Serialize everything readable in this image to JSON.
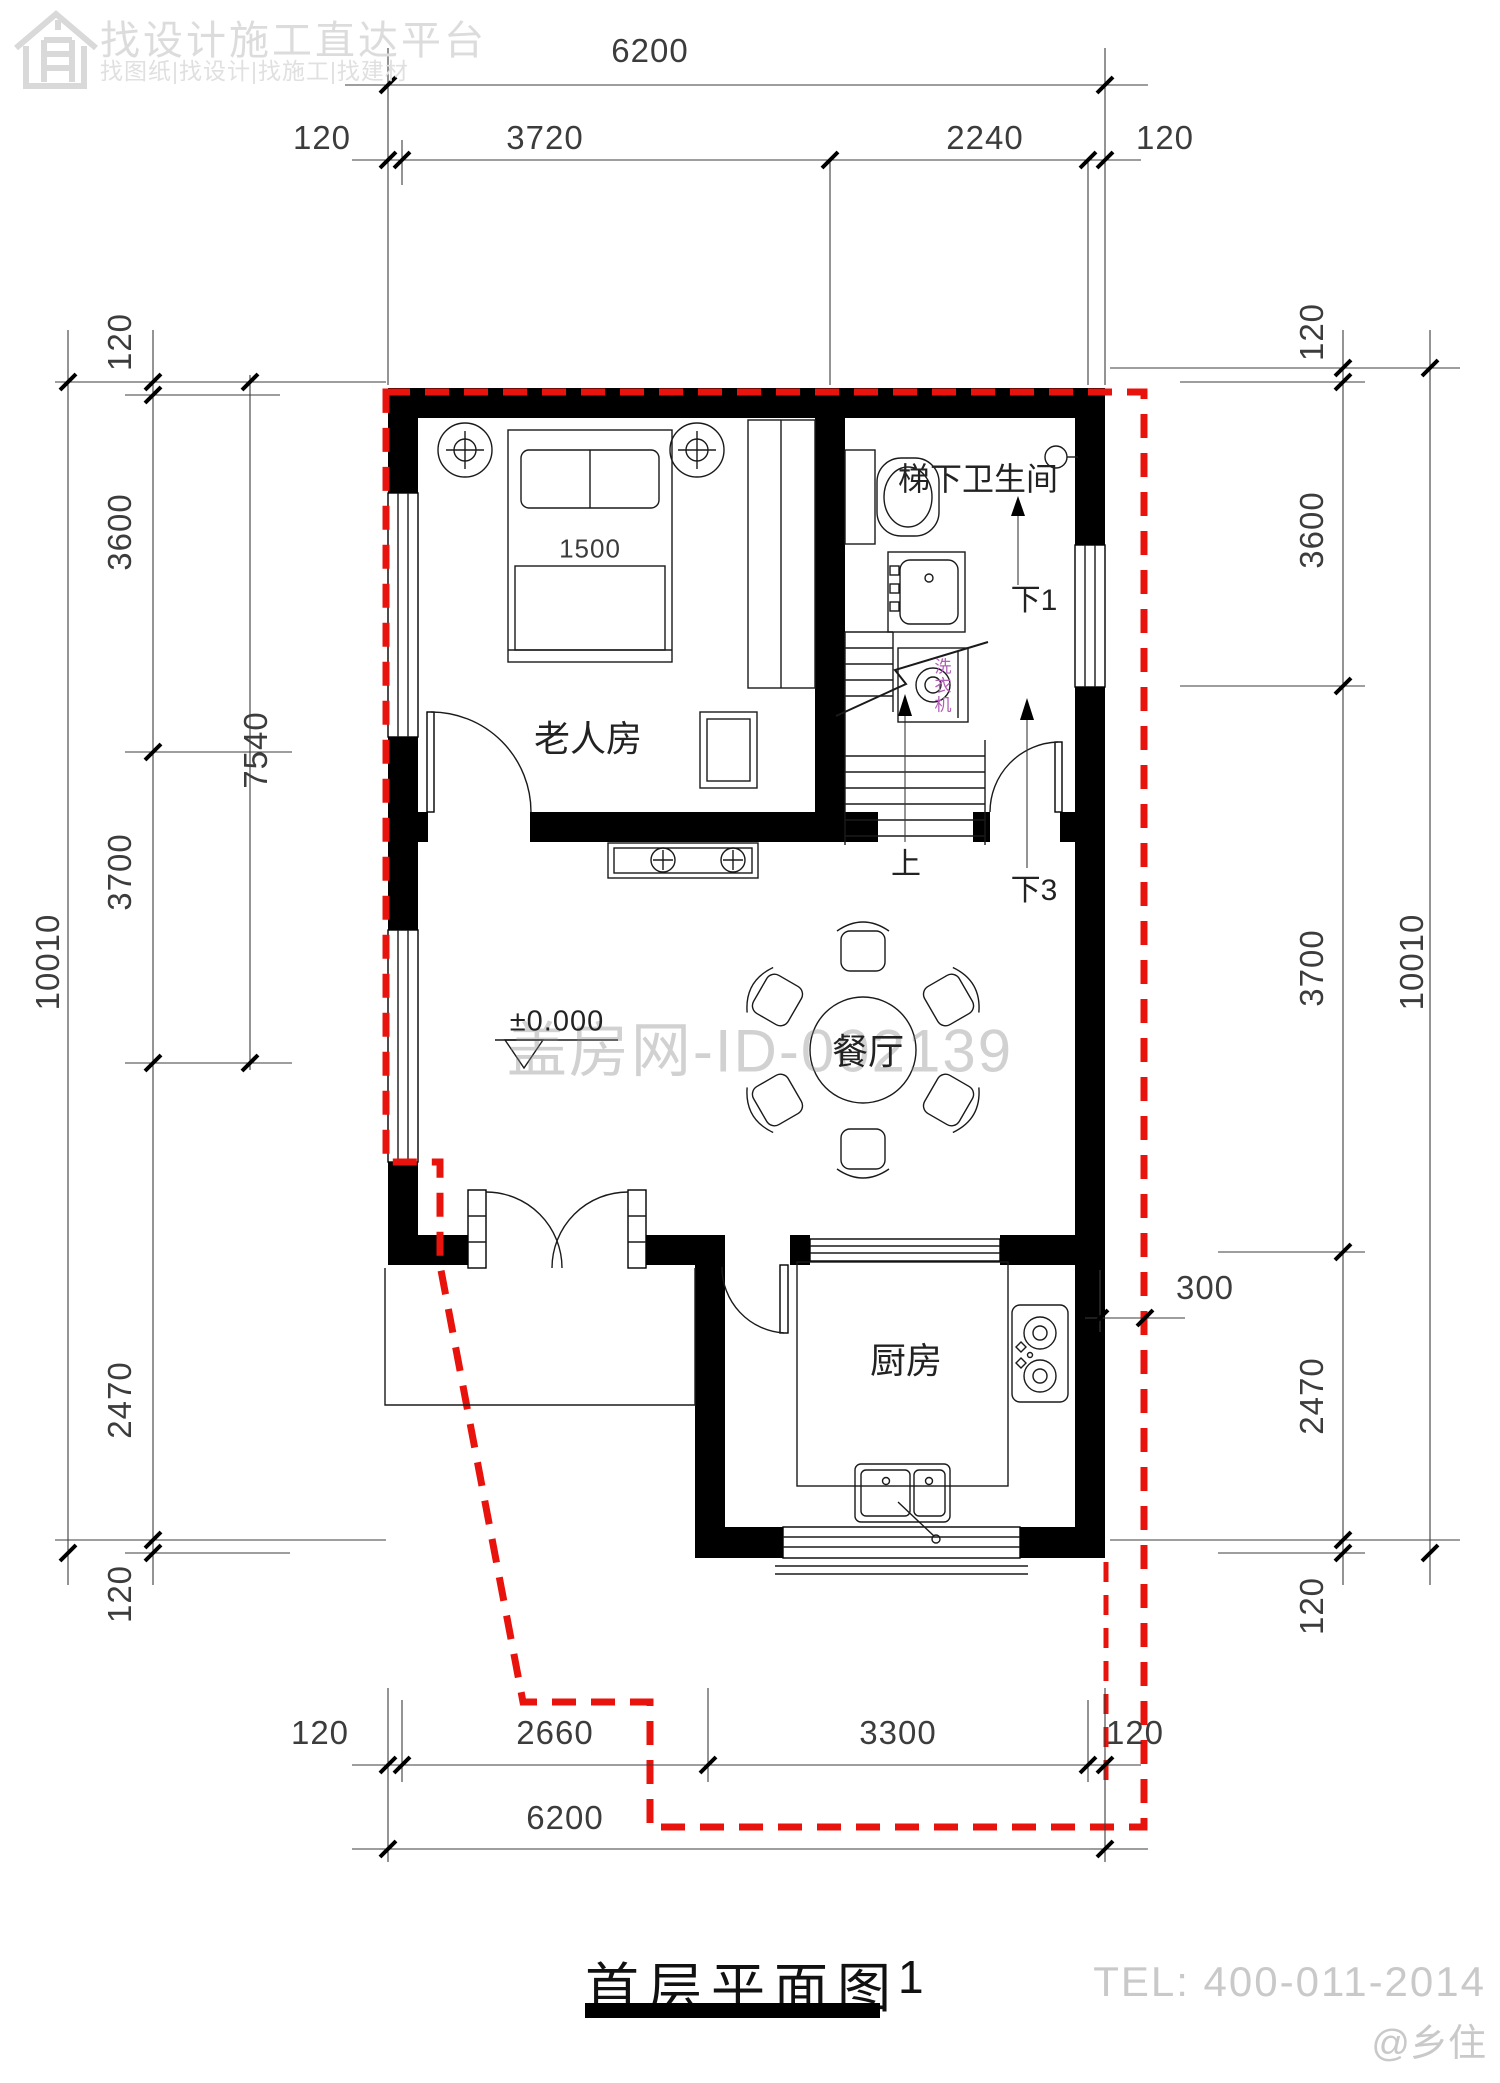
{
  "logo": {
    "title": "找设计施工直达平台",
    "subtitle": "找图纸|找设计|找施工|找建材"
  },
  "dimensions": {
    "top": {
      "total": "6200",
      "row": [
        "120",
        "3720",
        "2240",
        "120"
      ]
    },
    "bottom": {
      "total": "6200",
      "row": [
        "120",
        "2660",
        "3300",
        "120"
      ]
    },
    "left": {
      "overall": "10010",
      "upper_span": "7540",
      "row": [
        "120",
        "3600",
        "3700",
        "2470",
        "120"
      ]
    },
    "right": {
      "overall": "10010",
      "offset": "300",
      "row": [
        "120",
        "3600",
        "3700",
        "2470",
        "120"
      ]
    },
    "bed_width": "1500"
  },
  "rooms": {
    "bedroom": "老人房",
    "bathroom": "梯下卫生间",
    "dining": "餐厅",
    "kitchen": "厨房"
  },
  "stairs": {
    "up": "上",
    "down_one": "下1",
    "down_three": "下3"
  },
  "annotations": {
    "level": "±0.000",
    "washing_machine": "洗衣机"
  },
  "watermark": "盖房网-ID-002139",
  "title": {
    "text": "首层平面图",
    "number": "1"
  },
  "footer": {
    "tel": "TEL: 400-011-2014",
    "credit": "@乡住"
  },
  "colors": {
    "outline_red": "#e8130c",
    "wall": "#000000",
    "washer_label": "#b05fb5",
    "watermark_gray": "#878787"
  }
}
